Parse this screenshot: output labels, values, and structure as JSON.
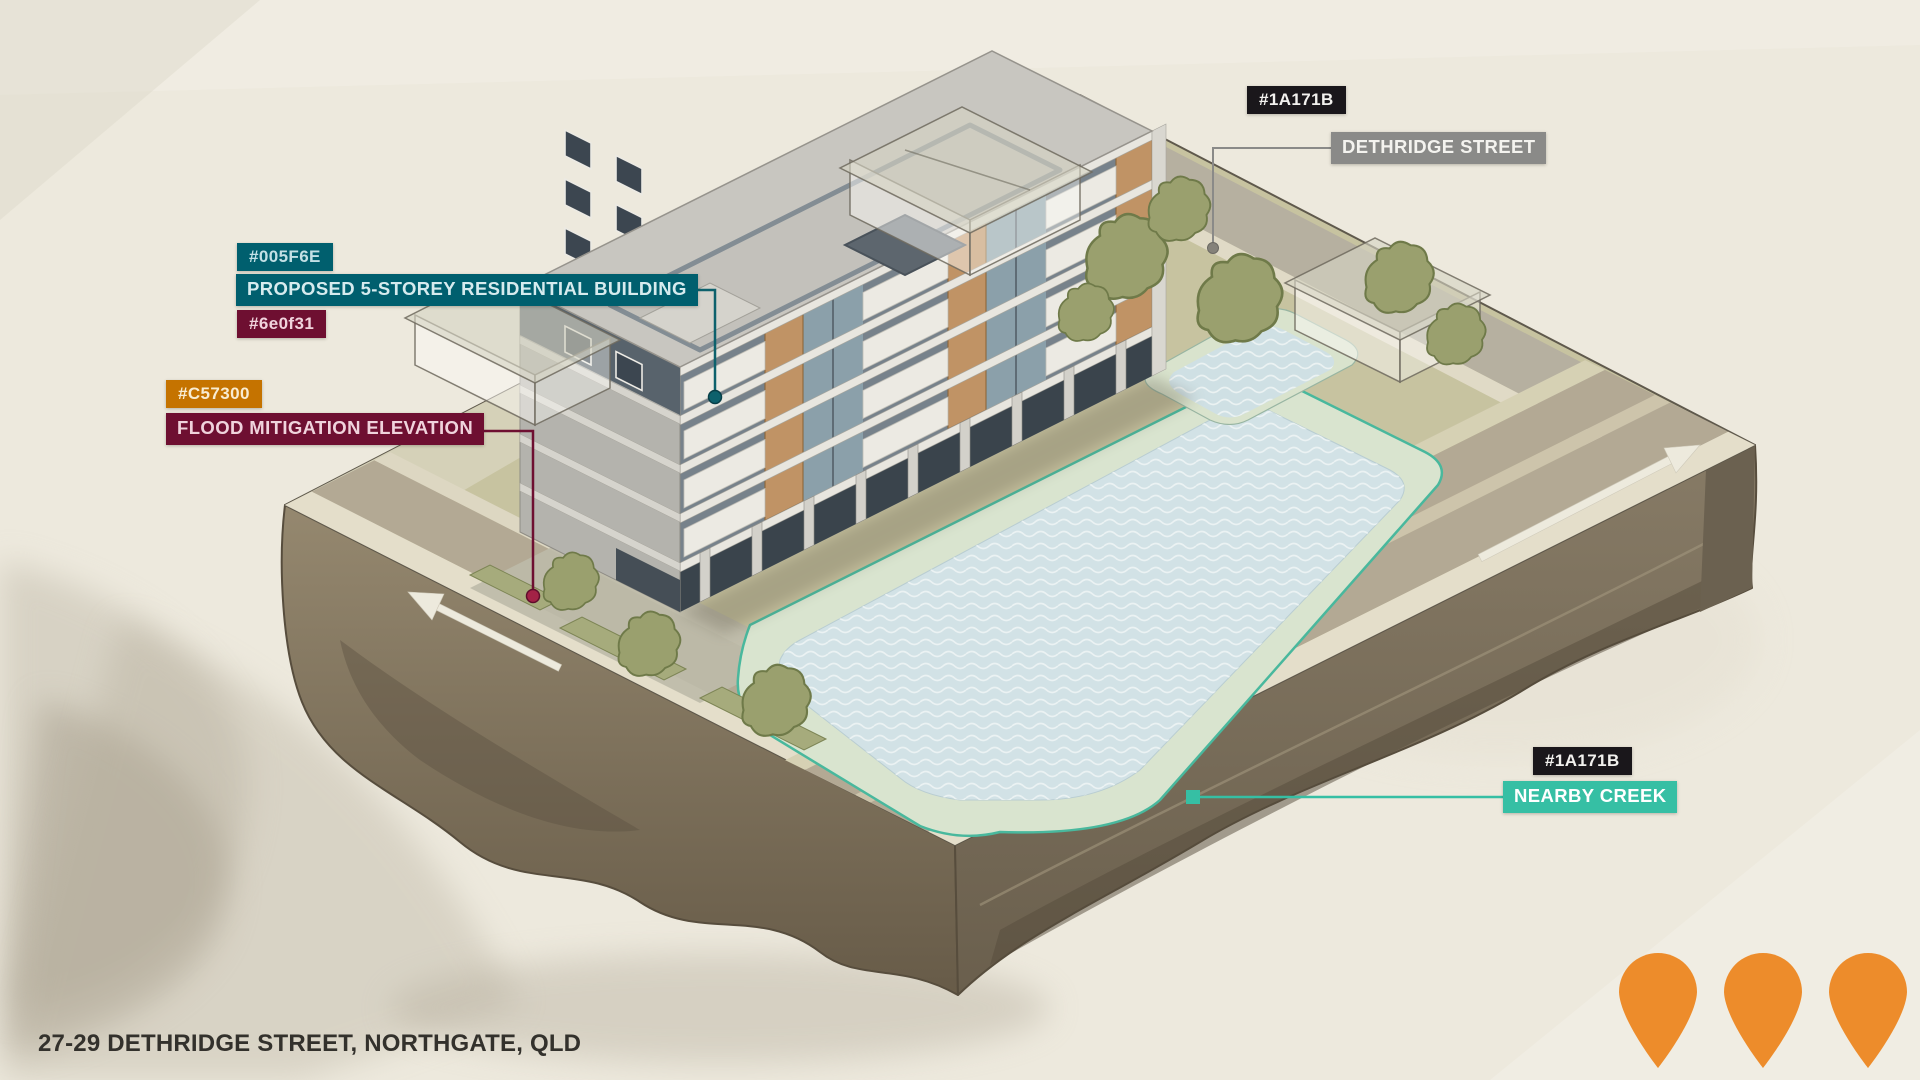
{
  "address": "27-29 DETHRIDGE STREET, NORTHGATE, QLD",
  "callouts": {
    "street": {
      "chip": "#1A171B",
      "label": "DETHRIDGE STREET"
    },
    "building": {
      "chip_top": "#005F6E",
      "label": "PROPOSED 5-STOREY RESIDENTIAL BUILDING",
      "chip_bottom": "#6e0f31"
    },
    "flood": {
      "chip": "#C57300",
      "label": "FLOOD MITIGATION ELEVATION"
    },
    "creek": {
      "chip": "#1A171B",
      "label": "NEARBY CREEK"
    }
  },
  "colors": {
    "chip_dark_bg": "#1A171B",
    "street_label_bg": "#8A8A88",
    "building_label_bg": "#005F6E",
    "flood_label_bg": "#6E0F31",
    "creek_label_bg": "#36BFA4",
    "map_pin": "#ED8C2B",
    "paper_background": "#EDE9DD"
  },
  "map_pins": {
    "count": 3
  }
}
